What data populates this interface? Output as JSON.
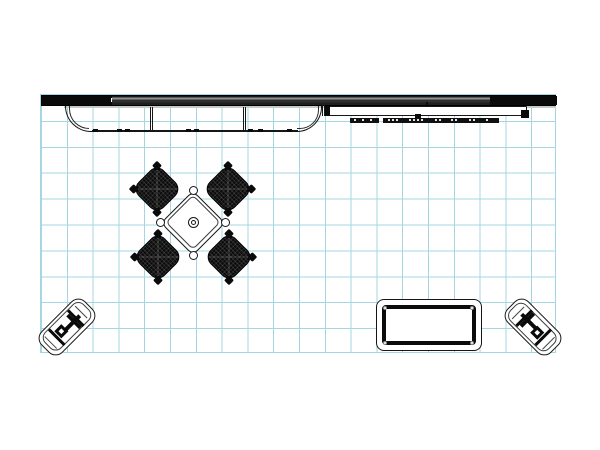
{
  "title": "Trade show booth floor plan (top view CAD drawing)",
  "canvas": {
    "width": 600,
    "height": 450,
    "background": "#ffffff"
  },
  "colors": {
    "grid": "#a4d7e1",
    "line": "#161616",
    "black": "#0a0a0a",
    "wall_gray": "#3f3f3f",
    "wall_highlight": "#929292",
    "under_strip": "#c9c9c9",
    "chair_fill": "#0c0c0c",
    "paper": "#ffffff"
  },
  "grid": {
    "x": 39.5,
    "y": 93.5,
    "width": 516,
    "height": 259,
    "cell": 25.8,
    "columns": 20,
    "rows": 10
  },
  "components": {
    "back_wall": {
      "left_black_end": true,
      "right_black_end": true,
      "gray_middle": true
    },
    "canopy_counter": {
      "rounded_ends": 2,
      "dividers": 2,
      "feet_dashes_x": [
        93,
        117,
        125,
        186,
        194,
        248,
        258,
        287
      ]
    },
    "lightbox_shelf": {
      "strip_a_marks_x": [
        4,
        12,
        20
      ],
      "strip_b_marks_x": [
        5,
        9,
        13,
        26,
        30,
        34,
        38,
        52,
        56,
        68,
        72,
        86,
        90,
        103
      ]
    },
    "conference_set": {
      "chairs": 4,
      "table_shape": "diamond",
      "vertex_circles": 4,
      "hub_circles": 2
    },
    "stools": 2,
    "display_case": {
      "bolts": 4
    }
  }
}
